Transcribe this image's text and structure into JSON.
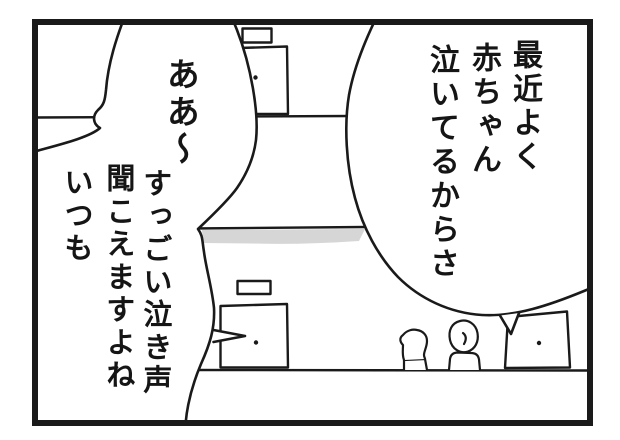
{
  "panel": {
    "background_color": "#ffffff",
    "line_color": "#1a1a1a",
    "awning_shadow_color": "#d6d6d6"
  },
  "speech": {
    "right_bubble": {
      "columns": [
        "最近よく",
        "赤ちゃん",
        "泣いてるからさ"
      ]
    },
    "left_bubble": {
      "columns": [
        "ああ〜",
        "すっごい泣き声",
        "聞こえますよね",
        "いつも"
      ]
    }
  }
}
